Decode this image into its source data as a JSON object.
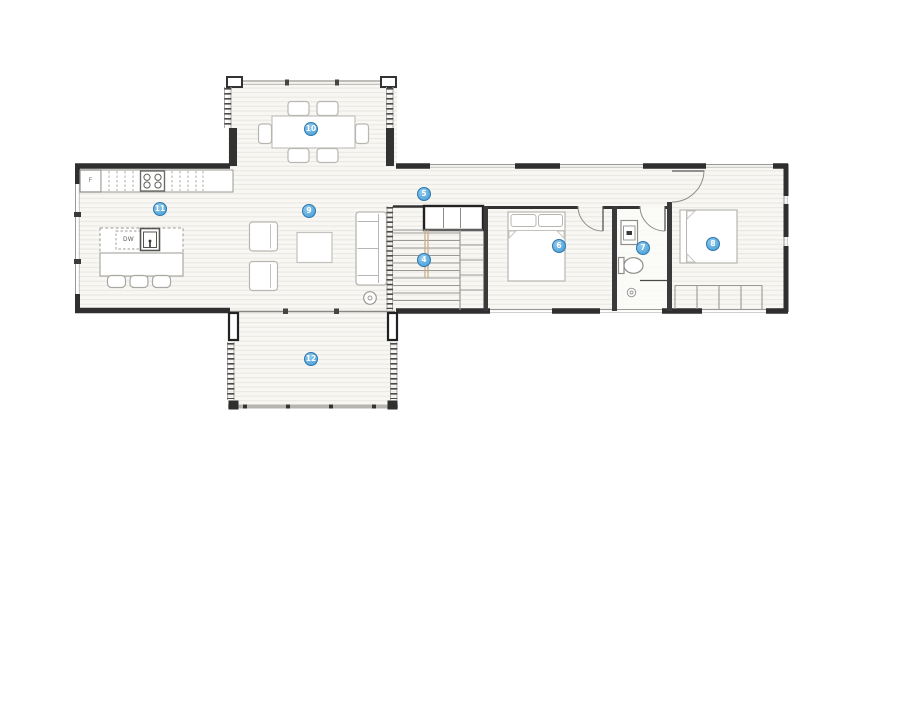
{
  "labels": {
    "fridge": "F",
    "dishwasher": "DW"
  },
  "markers": [
    {
      "number": "4"
    },
    {
      "number": "5"
    },
    {
      "number": "6"
    },
    {
      "number": "7"
    },
    {
      "number": "8"
    },
    {
      "number": "9"
    },
    {
      "number": "10"
    },
    {
      "number": "11"
    },
    {
      "number": "12"
    }
  ],
  "colors": {
    "marker-fill": "#55a7dc",
    "marker-fill-light": "#90c9ec",
    "marker-border": "#2d76ad",
    "marker-text": "#ffffff",
    "wall": "#2f2f2f",
    "window-line": "#9a9a99",
    "floor": "#f8f7f3",
    "floor-line": "#e9e7e1",
    "furniture-line": "#b8b6b0",
    "stair-stringer": "#c9ad8c"
  }
}
